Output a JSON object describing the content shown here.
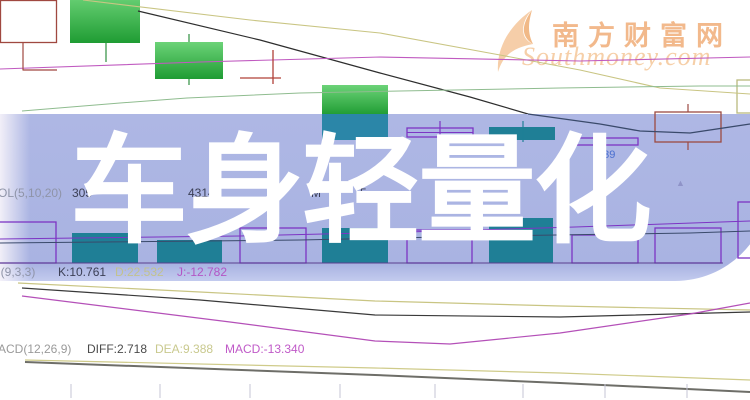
{
  "title": {
    "text": "车身轻量化",
    "color": "#ffffff"
  },
  "watermark": {
    "site_cn": "南方财富网",
    "site_en": "Southmoney.com",
    "logo": "feather-icon",
    "color": "#f2b98c"
  },
  "price_label": {
    "text": "9.39",
    "color": "#4a6fd0"
  },
  "up_marker": {
    "glyph": "▲",
    "color": "#8f93c8"
  },
  "indicator_rows": {
    "vol": {
      "label": "VOL(5,10,20)",
      "fragments": [
        {
          "text": "305",
          "x": 72,
          "color": "#3c4056"
        },
        {
          "text": "43140",
          "x": 188,
          "color": "#3c4056"
        },
        {
          "text": "M",
          "x": 311,
          "color": "#3c4056"
        },
        {
          "text": "5",
          "x": 360,
          "color": "#3c4056"
        }
      ],
      "label_color": "#8f94a8"
    },
    "kdj": {
      "label": "KDJ(9,3,3)",
      "label_color": "#8f94a8",
      "k": "K:10.761",
      "k_color": "#3c4056",
      "d": "D:22.532",
      "d_color": "#c2c28e",
      "j": "J:-12.782",
      "j_color": "#b355c5"
    },
    "macd": {
      "label": "MACD(12,26,9)",
      "label_color": "#9a9a9a",
      "diff": "DIFF:2.718",
      "diff_color": "#4a4a4a",
      "dea": "DEA:9.388",
      "dea_color": "#c9c98e",
      "macd": "MACD:-13.340",
      "macd_color": "#c05ac8"
    }
  },
  "chart": {
    "colors": {
      "banner": "#aeb7e4",
      "candle_green_hi": "#6cd378",
      "candle_green_lo": "#1f9c33",
      "teal_bar": "#1f7f96",
      "purple_outline": "#7d35c4",
      "dark_red": "#9c4a42",
      "price_line": "#3a4a6b",
      "tick": "#c4c4d4"
    },
    "rects": [
      {
        "name": "candle-hollow-red-1",
        "layer": "under",
        "x": 0.5,
        "y": 0.5,
        "w": 56,
        "h": 42,
        "stroke": "#a04840"
      },
      {
        "name": "candle-green-2",
        "layer": "under",
        "x": 70,
        "y": -6,
        "w": 70,
        "h": 49,
        "fill": "grad"
      },
      {
        "name": "candle-green-3",
        "layer": "under",
        "x": 155,
        "y": 42,
        "w": 68,
        "h": 37,
        "fill": "grad"
      },
      {
        "name": "candle-green-4-top",
        "layer": "under",
        "x": 322,
        "y": 85,
        "w": 66,
        "h": 30,
        "fill": "grad"
      },
      {
        "name": "box-khaki-partial",
        "layer": "under",
        "x": 737,
        "y": 80,
        "w": 20,
        "h": 33,
        "stroke": "#b9b97e"
      },
      {
        "name": "candle-green-4-bottom",
        "layer": "over",
        "x": 322,
        "y": 114,
        "w": 66,
        "h": 26,
        "fill": "#2b86a8"
      },
      {
        "name": "candle-hollow-purple-5",
        "layer": "over",
        "x": 407,
        "y": 128,
        "w": 66,
        "h": 9,
        "stroke": "#7d35c4"
      },
      {
        "name": "candle-teal-6",
        "layer": "over",
        "x": 489,
        "y": 127,
        "w": 66,
        "h": 13,
        "fill": "#1f7f96"
      },
      {
        "name": "candle-hollow-purple-7",
        "layer": "over",
        "x": 572,
        "y": 138,
        "w": 66,
        "h": 7,
        "stroke": "#7d35c4"
      },
      {
        "name": "candle-hollow-red-8",
        "layer": "over",
        "x": 655,
        "y": 112,
        "w": 66,
        "h": 30,
        "stroke": "#9c4a42"
      },
      {
        "name": "vol-bar-hollow-1",
        "layer": "over",
        "x": -8,
        "y": 222,
        "w": 64,
        "h": 41,
        "stroke": "#7d35c4"
      },
      {
        "name": "vol-bar-teal-2",
        "layer": "over",
        "x": 72,
        "y": 233,
        "w": 66,
        "h": 30,
        "fill": "#1f7f96"
      },
      {
        "name": "vol-bar-teal-3",
        "layer": "over",
        "x": 157,
        "y": 240,
        "w": 65,
        "h": 23,
        "fill": "#1f7f96"
      },
      {
        "name": "vol-bar-hollow-4",
        "layer": "over",
        "x": 240,
        "y": 228,
        "w": 66,
        "h": 35,
        "stroke": "#7d35c4"
      },
      {
        "name": "vol-bar-teal-5",
        "layer": "over",
        "x": 322,
        "y": 228,
        "w": 66,
        "h": 35,
        "fill": "#1f7f96"
      },
      {
        "name": "vol-bar-hollow-6",
        "layer": "over",
        "x": 407,
        "y": 230,
        "w": 65,
        "h": 33,
        "stroke": "#7d35c4"
      },
      {
        "name": "vol-bar-teal-7",
        "layer": "over",
        "x": 489,
        "y": 218,
        "w": 64,
        "h": 45,
        "fill": "#1f7f96"
      },
      {
        "name": "vol-bar-hollow-8",
        "layer": "over",
        "x": 572,
        "y": 235,
        "w": 66,
        "h": 28,
        "stroke": "#7d35c4"
      },
      {
        "name": "vol-bar-hollow-9",
        "layer": "over",
        "x": 655,
        "y": 228,
        "w": 66,
        "h": 35,
        "stroke": "#7d35c4"
      },
      {
        "name": "vol-bar-hollow-10",
        "layer": "over",
        "x": 738,
        "y": 202,
        "w": 20,
        "h": 56,
        "stroke": "#7d35c4"
      }
    ],
    "polylines": [
      {
        "name": "ma-khaki-top",
        "layer": "under",
        "color": "#c9c583",
        "w": 1.1,
        "pts": [
          [
            83,
            0
          ],
          [
            250,
            20
          ],
          [
            380,
            33
          ],
          [
            500,
            55
          ],
          [
            580,
            70
          ],
          [
            660,
            88
          ],
          [
            750,
            94
          ]
        ]
      },
      {
        "name": "price-line-upper",
        "layer": "under",
        "color": "#2e2e2e",
        "w": 1.2,
        "pts": [
          [
            138,
            11
          ],
          [
            260,
            40
          ],
          [
            380,
            73
          ],
          [
            470,
            97
          ],
          [
            528,
            114
          ]
        ]
      },
      {
        "name": "ma-magenta-top",
        "layer": "under",
        "color": "#c05ac0",
        "w": 1.1,
        "pts": [
          [
            0,
            69
          ],
          [
            200,
            62
          ],
          [
            380,
            57
          ],
          [
            580,
            61
          ],
          [
            750,
            57
          ]
        ]
      },
      {
        "name": "ma-green-top",
        "layer": "under",
        "color": "#8fbc8f",
        "w": 1,
        "pts": [
          [
            22,
            111
          ],
          [
            120,
            103
          ],
          [
            187,
            98
          ],
          [
            300,
            93
          ],
          [
            400,
            91
          ],
          [
            560,
            88
          ],
          [
            700,
            86
          ],
          [
            750,
            86
          ]
        ]
      },
      {
        "name": "red-step-line",
        "layer": "under",
        "color": "#a04840",
        "w": 1.2,
        "pts": [
          [
            23,
            43
          ],
          [
            23,
            70
          ],
          [
            57,
            70
          ]
        ]
      },
      {
        "name": "doji-vertical",
        "layer": "under",
        "color": "#b04038",
        "w": 1.3,
        "pts": [
          [
            273,
            50
          ],
          [
            273,
            84
          ]
        ]
      },
      {
        "name": "doji-horizontal",
        "layer": "under",
        "color": "#b04038",
        "w": 1.3,
        "pts": [
          [
            240,
            78
          ],
          [
            281,
            78
          ]
        ]
      },
      {
        "name": "wick-green-2",
        "layer": "under",
        "color": "#2f8f3f",
        "w": 1.2,
        "pts": [
          [
            106,
            43
          ],
          [
            106,
            62
          ]
        ]
      },
      {
        "name": "wick-green-3-top",
        "layer": "under",
        "color": "#2f8f3f",
        "w": 1.2,
        "pts": [
          [
            189,
            34
          ],
          [
            189,
            42
          ]
        ]
      },
      {
        "name": "wick-green-3-bot",
        "layer": "under",
        "color": "#2f8f3f",
        "w": 1.2,
        "pts": [
          [
            189,
            79
          ],
          [
            189,
            85
          ]
        ]
      },
      {
        "name": "kdj-d-line",
        "layer": "under",
        "color": "#c9c583",
        "w": 1.2,
        "pts": [
          [
            18,
            283
          ],
          [
            200,
            292
          ],
          [
            375,
            301
          ],
          [
            560,
            306
          ],
          [
            750,
            310
          ]
        ]
      },
      {
        "name": "kdj-k-line",
        "layer": "under",
        "color": "#3a3a3a",
        "w": 1.2,
        "pts": [
          [
            22,
            288
          ],
          [
            200,
            300
          ],
          [
            375,
            315
          ],
          [
            560,
            317
          ],
          [
            750,
            312
          ]
        ]
      },
      {
        "name": "kdj-j-line",
        "layer": "under",
        "color": "#b450b8",
        "w": 1.2,
        "pts": [
          [
            22,
            296
          ],
          [
            230,
            322
          ],
          [
            375,
            341
          ],
          [
            450,
            344
          ],
          [
            560,
            333
          ],
          [
            690,
            314
          ],
          [
            750,
            303
          ]
        ]
      },
      {
        "name": "macd-dea-line",
        "layer": "under",
        "color": "#cfcb8a",
        "w": 1.2,
        "pts": [
          [
            25,
            360
          ],
          [
            375,
            368
          ],
          [
            560,
            373
          ],
          [
            750,
            380
          ]
        ]
      },
      {
        "name": "macd-diff-line",
        "layer": "under",
        "color": "#6e6e68",
        "w": 2,
        "pts": [
          [
            25,
            362
          ],
          [
            375,
            375
          ],
          [
            560,
            383
          ],
          [
            750,
            392
          ]
        ]
      },
      {
        "name": "price-line-in-band",
        "layer": "over",
        "color": "#3a4a6b",
        "w": 1.3,
        "pts": [
          [
            528,
            114
          ],
          [
            600,
            124
          ],
          [
            640,
            131
          ],
          [
            690,
            133
          ],
          [
            750,
            124
          ]
        ]
      },
      {
        "name": "wick-purple-5",
        "layer": "over",
        "color": "#7d35c4",
        "w": 1.2,
        "pts": [
          [
            440,
            121
          ],
          [
            440,
            144
          ]
        ]
      },
      {
        "name": "dash-purple-5",
        "layer": "over",
        "color": "#7d35c4",
        "w": 1,
        "pts": [
          [
            407,
            132.5
          ],
          [
            473,
            132.5
          ]
        ]
      },
      {
        "name": "wick-teal-6",
        "layer": "over",
        "color": "#1f7f96",
        "w": 1.2,
        "pts": [
          [
            523,
            121
          ],
          [
            523,
            142
          ]
        ]
      },
      {
        "name": "wick-purple-7",
        "layer": "over",
        "color": "#7d35c4",
        "w": 1.2,
        "pts": [
          [
            605,
            145
          ],
          [
            605,
            163
          ]
        ]
      },
      {
        "name": "wick-red-8-top",
        "layer": "over",
        "color": "#9c4a42",
        "w": 1.2,
        "pts": [
          [
            688,
            104
          ],
          [
            688,
            112
          ]
        ]
      },
      {
        "name": "wick-red-8-bot",
        "layer": "over",
        "color": "#9c4a42",
        "w": 1.2,
        "pts": [
          [
            688,
            142
          ],
          [
            688,
            150
          ]
        ]
      },
      {
        "name": "vol-ma-purple",
        "layer": "over",
        "color": "#7d35c4",
        "w": 1,
        "pts": [
          [
            0,
            239
          ],
          [
            240,
            236
          ],
          [
            407,
            232
          ],
          [
            575,
            227
          ],
          [
            750,
            221
          ]
        ]
      },
      {
        "name": "vol-ma-dark",
        "layer": "over",
        "color": "#3a4a6b",
        "w": 1,
        "pts": [
          [
            0,
            243
          ],
          [
            300,
            240
          ],
          [
            490,
            236
          ],
          [
            690,
            233
          ],
          [
            750,
            231
          ]
        ]
      },
      {
        "name": "vol-baseline",
        "layer": "over",
        "color": "#5a3f8f",
        "w": 1,
        "pts": [
          [
            0,
            263
          ],
          [
            723,
            263
          ]
        ]
      }
    ],
    "axis_ticks_x": [
      71,
      160,
      250,
      340,
      435,
      523,
      605,
      687
    ]
  }
}
